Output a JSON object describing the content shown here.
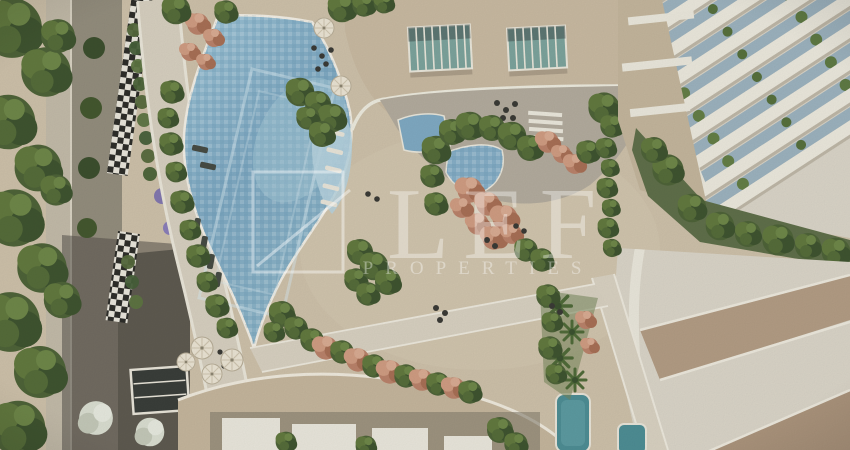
{
  "watermark": {
    "brand": "LEF",
    "tagline": "PROPERTIES"
  },
  "palette": {
    "pool_water": "#8fb6c8",
    "pool_water_light": "#a8cbd9",
    "kids_pool_blue": "#86aec6",
    "plunge_pool_teal": "#4e8d94",
    "skylight_teal": "#7ca39c",
    "deck_tan": "#cdc0a9",
    "roof_tan": "#c8b9a1",
    "terrace_gray": "#b2ab9d",
    "building_white": "#ebe8dc",
    "balcony_glass": "#9cb2be",
    "foliage_green": "#4e6338",
    "flower_salmon": "#b9826a",
    "flower_purple": "#8277ae",
    "road_gray": "#938d7d",
    "driveway_dark": "#5e5a50",
    "watermark_white": "#ffffff"
  }
}
